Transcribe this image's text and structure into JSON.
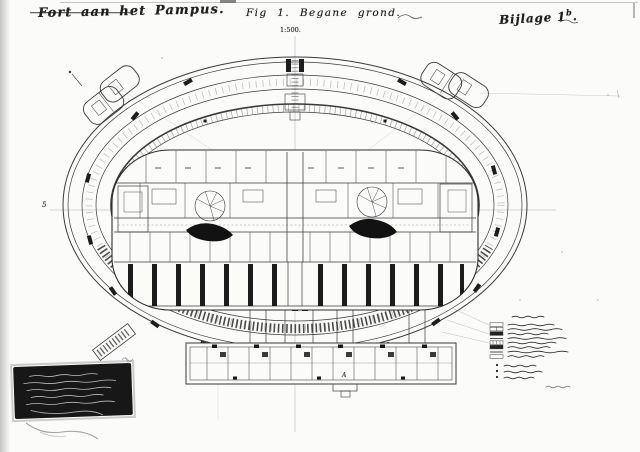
{
  "sheet": {
    "title": "Fort aan het Pampus.",
    "figure_caption": "Fig 1. Begane grond.",
    "scale": "1:500.",
    "annex_text": "Bijlage 1",
    "annex_sup": "b",
    "annex_period": ".",
    "marker_left": "5",
    "marker_bottom": "A"
  },
  "legend": {
    "swatch_rows": 8,
    "footnote_rows": 3
  },
  "stamp": {
    "text_lines": 5
  },
  "colors": {
    "ink": "#2e2e2e",
    "paper": "#fbfbfa",
    "stamp_bg": "#171717",
    "stamp_text": "#cdcdcd"
  }
}
